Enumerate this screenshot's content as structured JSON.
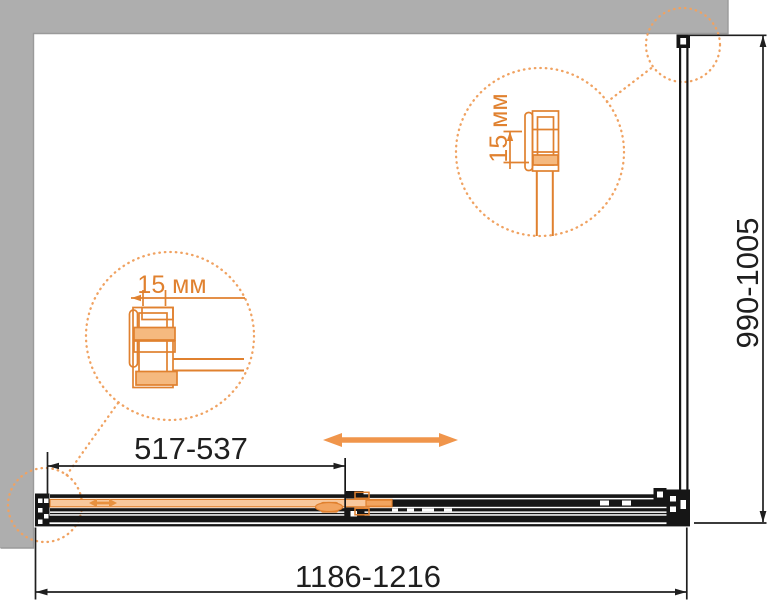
{
  "dimensions": {
    "total_width": "1186-1216",
    "side_depth": "990-1005",
    "door_opening": "517-537"
  },
  "details": {
    "top_profile_adjustment": "15 мм",
    "left_profile_adjustment": "15 мм"
  },
  "colors": {
    "accent_orange": "#E8873C",
    "detail_orange": "#F0A261",
    "wall_gray": "#AEAEAE",
    "line_black": "#1F1F1F"
  }
}
